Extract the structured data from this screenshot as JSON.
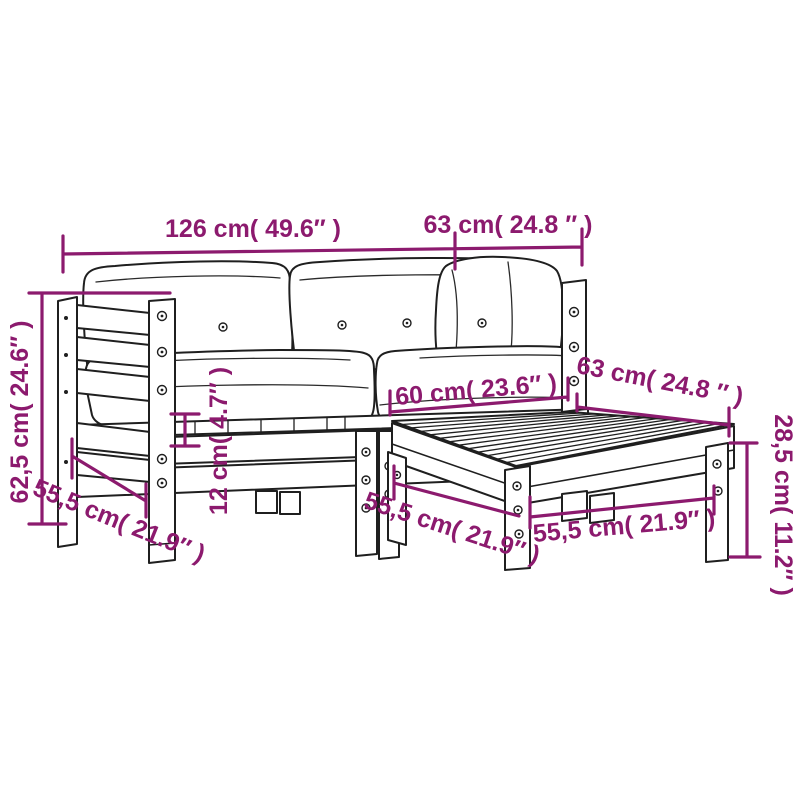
{
  "diagram": {
    "type": "furniture-dimension-diagram",
    "product": "2-piece garden sofa set with footstool",
    "accent_color": "#8C1A6E",
    "line_color": "#1F1F1F",
    "background_color": "#FFFFFF",
    "labels": {
      "sofa_width": "126 cm( 49.6″ )",
      "sofa_depth_top": "63 cm( 24.8 ″ )",
      "sofa_height": "62,5 cm( 24.6″ )",
      "sofa_depth_side": "55,5 cm( 21.9″ )",
      "frame_rail_height": "12 cm( 4.7″ )",
      "seat_width": "60 cm( 23.6″ )",
      "ottoman_depth_back": "63 cm( 24.8 ″ )",
      "ottoman_height": "28,5 cm( 11.2″ )",
      "ottoman_depth_side": "55,5 cm( 21.9″ )",
      "ottoman_width_front": "55,5 cm( 21.9″ )"
    }
  }
}
